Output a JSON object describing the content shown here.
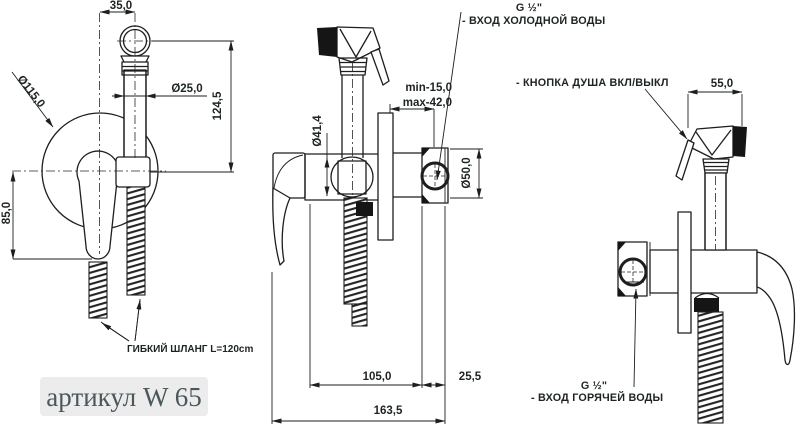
{
  "title_block": {
    "article": "артикул W 65"
  },
  "labels": {
    "hose": "ГИБКИЙ ШЛАНГ L=120cm",
    "cold_thread": "G ½\"",
    "cold_inlet": "- ВХОД ХОЛОДНОЙ ВОДЫ",
    "hot_thread": "G ½\"",
    "hot_inlet": "- ВХОД ГОРЯЧЕЙ ВОДЫ",
    "shower_button": "- КНОПКА ДУША ВКЛ/ВЫКЛ"
  },
  "dimensions": {
    "front_offset": "35,0",
    "plate_diameter": "Ø115,0",
    "handle_diameter": "Ø25,0",
    "front_height": "124,5",
    "handle_drop": "85,0",
    "holder_diameter": "Ø41,4",
    "depth_min": "min-15,0",
    "depth_max": "max-42,0",
    "valve_diameter": "Ø50,0",
    "body_length": "105,0",
    "valve_depth": "25,5",
    "total_depth": "163,5",
    "head_length": "55,0"
  },
  "colors": {
    "line": "#1e1e1e",
    "article_text": "#4a585c",
    "article_bg": "#ececec"
  }
}
